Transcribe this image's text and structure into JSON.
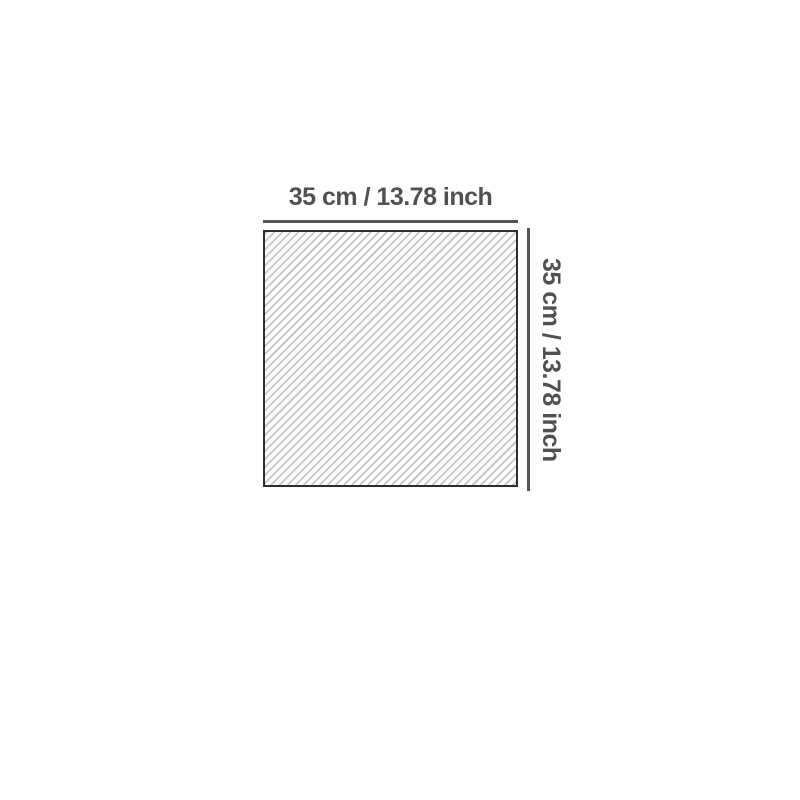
{
  "diagram": {
    "type": "product-dimension-diagram",
    "shape": "square-with-diagonal-hatch",
    "top_dimension": {
      "label": "35 cm / 13.78 inch",
      "value_cm": 35,
      "value_inch": 13.78
    },
    "side_dimension": {
      "label": "35 cm / 13.78 inch",
      "value_cm": 35,
      "value_inch": 13.78
    },
    "colors": {
      "background": "#ffffff",
      "label_text": "#515151",
      "dimension_line": "#555555",
      "square_border": "#2e2e2e",
      "hatch_line": "#c6c6c6",
      "square_fill": "#ffffff"
    }
  }
}
